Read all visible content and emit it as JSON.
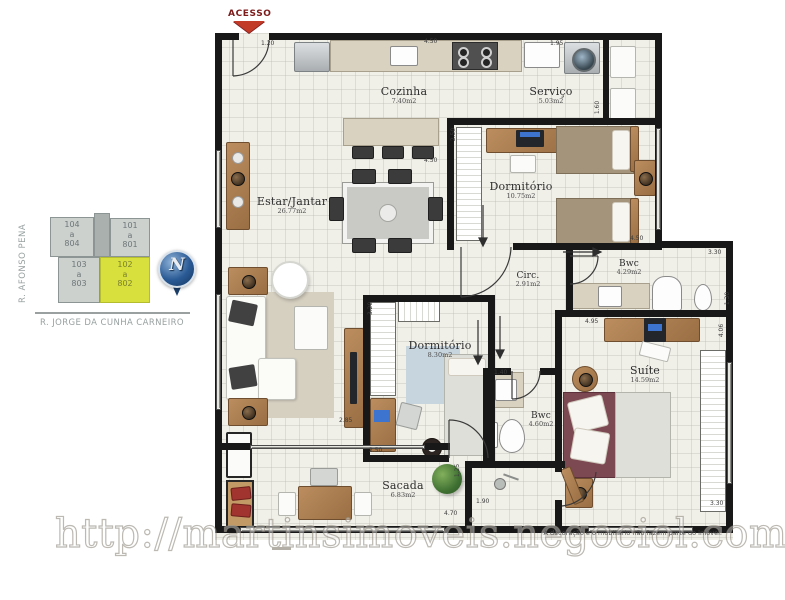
{
  "access_label": "ACESSO",
  "watermark_text": "http://martinsimoveis.negociol.com",
  "disclaimer_text": "A decoração e o mobiliário não fazem parte do imóvel.",
  "keyplan": {
    "street_vertical": "R. AFONSO PENA",
    "street_horizontal": "R. JORGE DA CUNHA CARNEIRO",
    "compass_letter": "N",
    "highlight_color": "#d7e03c",
    "units": [
      {
        "line1": "104",
        "line2": "a",
        "line3": "804",
        "highlighted": false
      },
      {
        "line1": "101",
        "line2": "a",
        "line3": "801",
        "highlighted": false
      },
      {
        "line1": "103",
        "line2": "a",
        "line3": "803",
        "highlighted": false
      },
      {
        "line1": "102",
        "line2": "a",
        "line3": "802",
        "highlighted": true
      }
    ]
  },
  "rooms": [
    {
      "name": "Cozinha",
      "area": "7.40m2"
    },
    {
      "name": "Serviço",
      "area": "5.03m2"
    },
    {
      "name": "Dormitório",
      "area": "10.75m2"
    },
    {
      "name": "Estar/Jantar",
      "area": "26.77m2"
    },
    {
      "name": "Circ.",
      "area": "2.91m2"
    },
    {
      "name": "Bwc",
      "area": "4.29m2"
    },
    {
      "name": "Dormitório",
      "area": "8.30m2"
    },
    {
      "name": "Bwc",
      "area": "4.60m2"
    },
    {
      "name": "Suíte",
      "area": "14.59m2"
    },
    {
      "name": "Sacada",
      "area": "6.83m2"
    }
  ],
  "dims": [
    {
      "v": "1.20"
    },
    {
      "v": "4.50"
    },
    {
      "v": "1.95"
    },
    {
      "v": "2.50"
    },
    {
      "v": "4.50"
    },
    {
      "v": "1.60"
    },
    {
      "v": "3.30"
    },
    {
      "v": "1.30"
    },
    {
      "v": "4.95"
    },
    {
      "v": "4.06"
    },
    {
      "v": "3.20"
    },
    {
      "v": "2.50"
    },
    {
      "v": "1.40"
    },
    {
      "v": "1.90"
    },
    {
      "v": "4.70"
    },
    {
      "v": "2.85"
    },
    {
      "v": "1.25"
    },
    {
      "v": "3.30"
    },
    {
      "v": "4.50"
    }
  ]
}
